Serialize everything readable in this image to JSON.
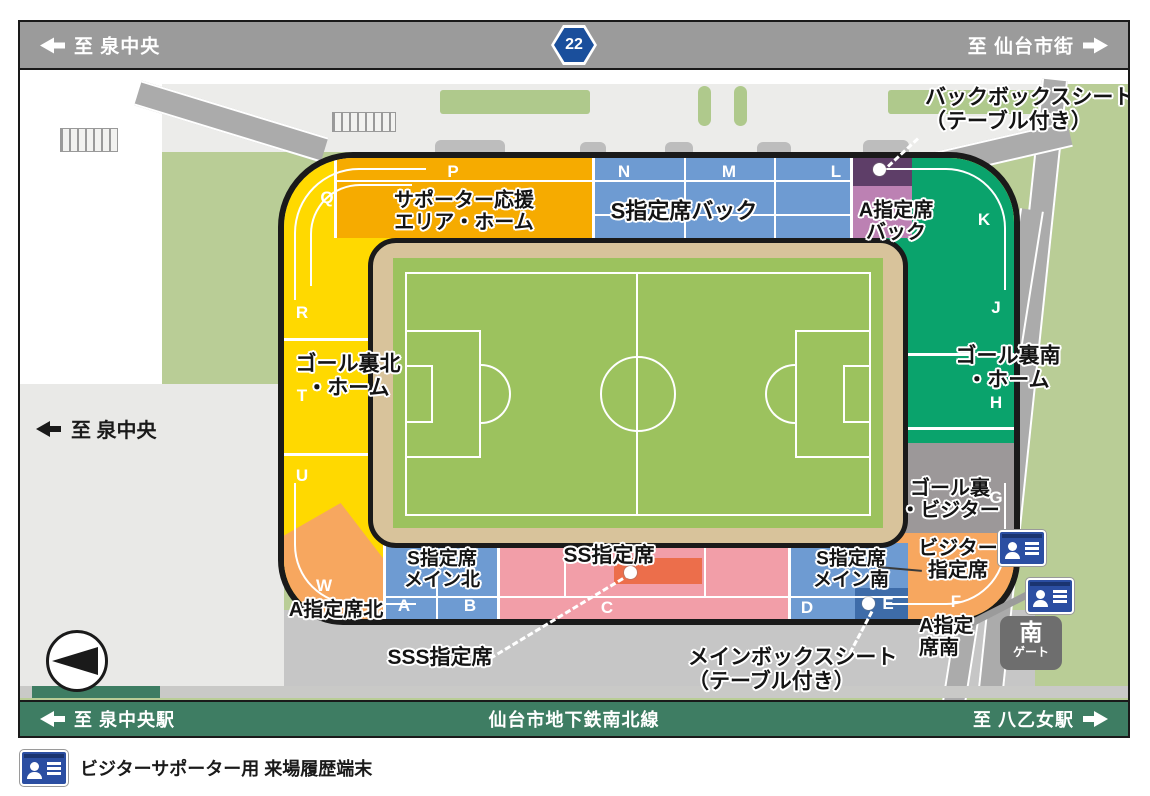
{
  "top_bar": {
    "left_label": "至 泉中央",
    "route_number": "22",
    "right_label": "至 仙台市街"
  },
  "bottom_bar": {
    "left_label": "至 泉中央駅",
    "center_label": "仙台市地下鉄南北線",
    "right_label": "至 八乙女駅"
  },
  "road_labels": {
    "west": "至 泉中央"
  },
  "legend": {
    "terminal_label": "ビジターサポーター用 来場履歴端末"
  },
  "gate": {
    "name_large": "南",
    "name_small": "ゲート"
  },
  "sections": {
    "supporter_area": {
      "line1": "サポーター応援",
      "line2": "エリア・ホーム"
    },
    "s_back": "S指定席バック",
    "a_back": {
      "line1": "A指定席",
      "line2": "バック"
    },
    "goal_north": {
      "line1": "ゴール裏北",
      "line2": "・ホーム"
    },
    "goal_south": {
      "line1": "ゴール裏南",
      "line2": "・ホーム"
    },
    "goal_visitor": {
      "line1": "ゴール裏",
      "line2": "・ビジター"
    },
    "visitor_seat": {
      "line1": "ビジター",
      "line2": "指定席"
    },
    "a_north": "A指定席北",
    "a_south": {
      "line1": "A指定",
      "line2": "席南"
    },
    "s_main_north": {
      "line1": "S指定席",
      "line2": "メイン北"
    },
    "ss": "SS指定席",
    "s_main_south": {
      "line1": "S指定席",
      "line2": "メイン南"
    }
  },
  "callouts": {
    "back_box": {
      "line1": "バックボックスシート",
      "line2": "（テーブル付き）"
    },
    "sss": "SSS指定席",
    "main_box": {
      "line1": "メインボックスシート",
      "line2": "（テーブル付き）"
    }
  },
  "letters": {
    "p": "P",
    "q": "Q",
    "n": "N",
    "m": "M",
    "l": "L",
    "k": "K",
    "r": "R",
    "j": "J",
    "t": "T",
    "h": "H",
    "u": "U",
    "g": "G",
    "w": "W",
    "a": "A",
    "b": "B",
    "c": "C",
    "d": "D",
    "e": "E",
    "f": "F"
  },
  "colors": {
    "yellow": "#FFD900",
    "orange": "#F6AB00",
    "blue": "#6E9BD2",
    "pink": "#F29EA8",
    "mauve": "#BC81B3",
    "purple": "#5E3E68",
    "teal": "#0AA36C",
    "grayv": "#9C9899",
    "orangev": "#F7A75F",
    "sss": "#EC6E4B",
    "navy": "#3E6CA9",
    "track": "#D8C39B",
    "grass": "#9CC25E",
    "bargreen": "#3E7D63",
    "route": "#1A4F9C",
    "topbar": "#9B9B9B",
    "mapgreen": "#B9CD96"
  }
}
